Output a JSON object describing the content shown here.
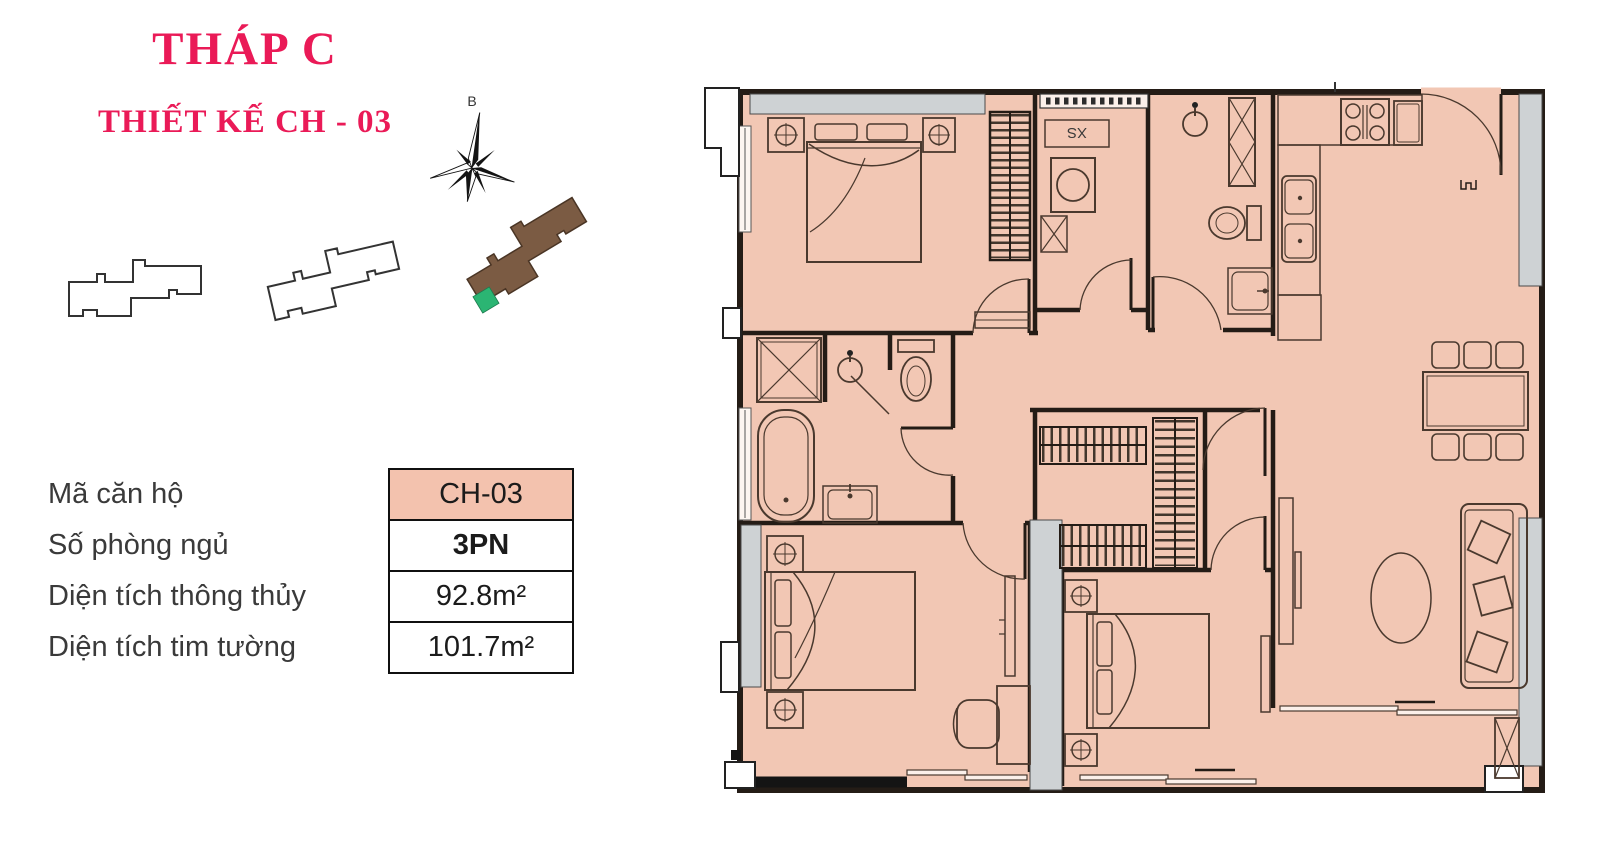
{
  "page": {
    "background": "#ffffff"
  },
  "header": {
    "title": "THÁP C",
    "subtitle": "THIẾT KẾ CH - 03",
    "accent_color": "#ea1a57"
  },
  "compass": {
    "north_label": "B"
  },
  "key_plans": {
    "towers": [
      {
        "name": "tower-outline-left",
        "fill": "#ffffff"
      },
      {
        "name": "tower-outline-middle",
        "fill": "#ffffff"
      },
      {
        "name": "tower-c-highlighted",
        "fill": "#7b5b43",
        "highlight_unit_color": "#2bb573"
      }
    ]
  },
  "info_table": {
    "rows": [
      {
        "label": "Mã căn hộ",
        "value": "CH-03"
      },
      {
        "label": "Số phòng ngủ",
        "value": "3PN"
      },
      {
        "label": "Diện tích thông thủy",
        "value": "92.8m²"
      },
      {
        "label": "Diện tích tim tường",
        "value": "101.7m²"
      }
    ],
    "highlight_color": "#f3c2ae"
  },
  "floor_plan": {
    "washer_shelf_label": "XS",
    "colors": {
      "floor": "#f2c7b4",
      "wall": "#241c16",
      "column": "#ced2d4"
    }
  }
}
